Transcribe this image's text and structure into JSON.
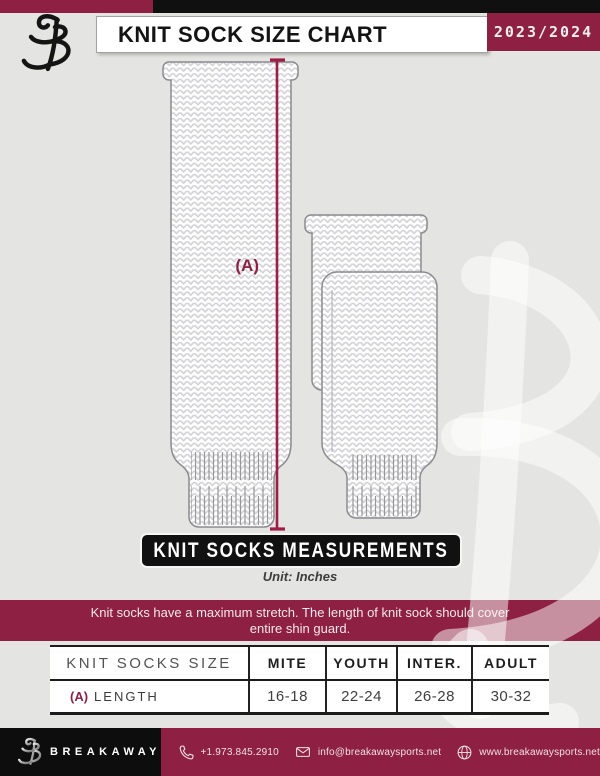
{
  "header": {
    "title": "KNIT SOCK SIZE CHART",
    "season": "2023/2024",
    "logo_icon": "breakaway-b-logo"
  },
  "diagram": {
    "measure_label": "(A)",
    "banner": "KNIT SOCKS MEASUREMENTS",
    "unit": "Unit: Inches",
    "note_line1": "Knit socks have a maximum stretch. The length of knit sock should cover",
    "note_line2": "entire shin guard."
  },
  "table": {
    "columns": [
      "KNIT SOCKS SIZE",
      "MITE",
      "YOUTH",
      "INTER.",
      "ADULT"
    ],
    "rows": [
      {
        "prefix": "(A)",
        "label": "LENGTH",
        "values": [
          "16-18",
          "22-24",
          "26-28",
          "30-32"
        ]
      }
    ]
  },
  "footer": {
    "brand": "BREAKAWAY",
    "contacts": [
      {
        "icon": "phone-icon",
        "text": "+1.973.845.2910"
      },
      {
        "icon": "envelope-icon",
        "text": "info@breakawaysports.net"
      },
      {
        "icon": "globe-icon",
        "text": "www.breakawaysports.net"
      }
    ]
  },
  "colors": {
    "maroon": "#8E2043",
    "black": "#101010",
    "background": "#E4E4E2",
    "measure_line": "#9E1C46"
  }
}
